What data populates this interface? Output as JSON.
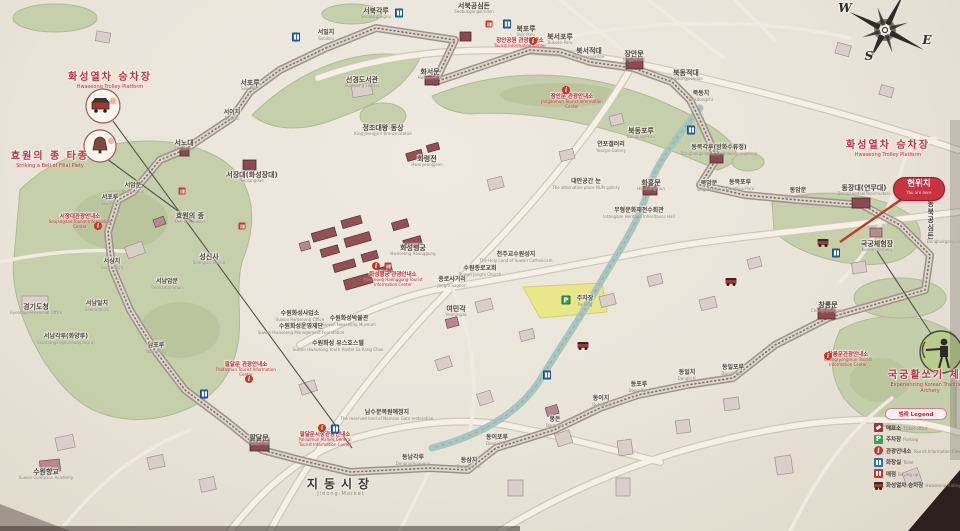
{
  "meta": {
    "description": "Illustrated tourist map of Suwon Hwaseong Fortress (photographed signboard)"
  },
  "compass": {
    "letters": [
      {
        "t": "W",
        "x": 845,
        "y": 2
      },
      {
        "t": "S",
        "x": 869,
        "y": 50
      },
      {
        "t": "E",
        "x": 927,
        "y": 34
      }
    ]
  },
  "you_are_here": {
    "ko": "현위치",
    "en": "You are here"
  },
  "legend": {
    "title_ko": "범례",
    "title_en": "Legend",
    "items": [
      {
        "icon": "ticket-office",
        "ko": "매표소",
        "en": "Ticket office"
      },
      {
        "icon": "parking",
        "ko": "주차장",
        "en": "Parking"
      },
      {
        "icon": "tourist-information",
        "ko": "관광안내소",
        "en": "Tourist Information Center"
      },
      {
        "icon": "toilet",
        "ko": "화장실",
        "en": "Toilet"
      },
      {
        "icon": "snack-shop",
        "ko": "매점",
        "en": "Buying up"
      },
      {
        "icon": "trolley",
        "ko": "화성열차 승차장",
        "en": "Hwaseong Trolley Platform"
      }
    ]
  },
  "colors": {
    "accent_red": "#c5293c",
    "park_green": "#c2cda6",
    "paper": "#e9e4d8",
    "wall_gray": "#9b9289"
  },
  "map": {
    "labels": [
      {
        "x": 110,
        "y": 72,
        "ko": "화성열차 승차장",
        "en": "Hwaseong Trolley Platform",
        "kind": "feature"
      },
      {
        "x": 50,
        "y": 151,
        "ko": "효원의 종 타종",
        "en": "Striking a Bell of Filial Piety",
        "kind": "feature"
      },
      {
        "x": 888,
        "y": 140,
        "ko": "화성열차 승차장",
        "en": "Hwaseong Trolley Platform",
        "kind": "feature"
      },
      {
        "x": 930,
        "y": 370,
        "ko": "국궁활쏘기 체험",
        "en": "Experiencing Korean Traditional Archery",
        "kind": "feature"
      },
      {
        "x": 520,
        "y": 38,
        "ko": "장안공원 관광안내소",
        "en": "Tourist Information Center",
        "kind": "info"
      },
      {
        "x": 572,
        "y": 94,
        "ko": "장안문 관광안내소",
        "en": "Janganmun Tourist Information Center",
        "kind": "info"
      },
      {
        "x": 393,
        "y": 272,
        "ko": "화성행궁 관광안내소",
        "en": "Hwaseong Haenggung Tourist Information Center",
        "kind": "info"
      },
      {
        "x": 80,
        "y": 214,
        "ko": "서장대관광안내소",
        "en": "Seojangdae Tourist Information Center",
        "kind": "info"
      },
      {
        "x": 246,
        "y": 362,
        "ko": "팔달문 관광안내소",
        "en": "Paldalmun Tourist Information Center",
        "kind": "info"
      },
      {
        "x": 325,
        "y": 432,
        "ko": "팔달문시장관광안내소",
        "en": "Paldalmun Market General Tourist Information Center",
        "kind": "info"
      },
      {
        "x": 848,
        "y": 352,
        "ko": "창룡문관광안내소",
        "en": "Changryongmun Tourist Information Center",
        "kind": "info"
      },
      {
        "x": 376,
        "y": 7,
        "ko": "서북각루",
        "en": "Seobukgangnu",
        "kind": "place"
      },
      {
        "x": 474,
        "y": 2,
        "ko": "서북공심돈",
        "en": "Seobukgongsimdon",
        "kind": "place"
      },
      {
        "x": 326,
        "y": 30,
        "ko": "서일치",
        "en": "Seoilchi",
        "kind": "small"
      },
      {
        "x": 526,
        "y": 25,
        "ko": "북포루",
        "en": "Buk-Poru",
        "kind": "place"
      },
      {
        "x": 560,
        "y": 33,
        "ko": "북서포루",
        "en": "Bukseo-Poru",
        "kind": "place"
      },
      {
        "x": 589,
        "y": 47,
        "ko": "북서적대",
        "en": "Bukseojeokdae",
        "kind": "place"
      },
      {
        "x": 634,
        "y": 50,
        "ko": "장안문",
        "en": "Janganmun",
        "kind": "place"
      },
      {
        "x": 686,
        "y": 69,
        "ko": "북동적대",
        "en": "Bukdongjeokdae",
        "kind": "place"
      },
      {
        "x": 701,
        "y": 91,
        "ko": "북동치",
        "en": "Bukdongchi",
        "kind": "small"
      },
      {
        "x": 430,
        "y": 68,
        "ko": "화서문",
        "en": "Hwaseomun",
        "kind": "place"
      },
      {
        "x": 362,
        "y": 76,
        "ko": "선경도서관",
        "en": "Sunkyung Library",
        "kind": "place"
      },
      {
        "x": 250,
        "y": 79,
        "ko": "서포루",
        "en": "Seo-Poru",
        "kind": "place"
      },
      {
        "x": 232,
        "y": 110,
        "ko": "서이치",
        "en": "Seoichi",
        "kind": "small"
      },
      {
        "x": 184,
        "y": 139,
        "ko": "서노대",
        "en": "Seonodae",
        "kind": "place"
      },
      {
        "x": 252,
        "y": 171,
        "ko": "서장대(화성장대)",
        "en": "Seojangdae",
        "kind": "place"
      },
      {
        "x": 133,
        "y": 183,
        "ko": "서암문",
        "en": "Seoammun",
        "kind": "small"
      },
      {
        "x": 110,
        "y": 195,
        "ko": "서포루",
        "en": "Seo-Poru",
        "kind": "small"
      },
      {
        "x": 190,
        "y": 212,
        "ko": "효원의 종",
        "en": "Bell of Hyowon",
        "kind": "place"
      },
      {
        "x": 209,
        "y": 253,
        "ko": "성신사",
        "en": "Seongsin Shrine",
        "kind": "place"
      },
      {
        "x": 112,
        "y": 259,
        "ko": "서삼치",
        "en": "Seosamchi",
        "kind": "small"
      },
      {
        "x": 167,
        "y": 279,
        "ko": "서남암문",
        "en": "Seonamammun",
        "kind": "small"
      },
      {
        "x": 97,
        "y": 301,
        "ko": "서남일치",
        "en": "Seonamilchi",
        "kind": "small"
      },
      {
        "x": 36,
        "y": 303,
        "ko": "경기도청",
        "en": "Gyeonggi Provincial Office",
        "kind": "place"
      },
      {
        "x": 66,
        "y": 334,
        "ko": "서남각루(화양루)",
        "en": "Seonamgangnu(Hwayangru)",
        "kind": "small"
      },
      {
        "x": 156,
        "y": 343,
        "ko": "남포루",
        "en": "Nam-Poru",
        "kind": "small"
      },
      {
        "x": 46,
        "y": 468,
        "ko": "수원향교",
        "en": "Suwon Confucian Academy",
        "kind": "place"
      },
      {
        "x": 383,
        "y": 124,
        "ko": "정조대왕 동상",
        "en": "King Jeongjo's Bronze Statue",
        "kind": "place"
      },
      {
        "x": 427,
        "y": 155,
        "ko": "화령전",
        "en": "Hwaryeongjeon",
        "kind": "place"
      },
      {
        "x": 413,
        "y": 244,
        "ko": "화성행궁",
        "en": "Hwaseong Haenggung",
        "kind": "place"
      },
      {
        "x": 452,
        "y": 277,
        "ko": "종로사거리",
        "en": "Jongro Sageori",
        "kind": "small"
      },
      {
        "x": 456,
        "y": 305,
        "ko": "여민각",
        "en": "Yeomingak",
        "kind": "place"
      },
      {
        "x": 516,
        "y": 252,
        "ko": "천주교수원성지",
        "en": "The Holy Land of Suwon Catholicism",
        "kind": "small"
      },
      {
        "x": 480,
        "y": 266,
        "ko": "수원종로교회",
        "en": "Suwon Jongro Church",
        "kind": "small"
      },
      {
        "x": 641,
        "y": 127,
        "ko": "북동포루",
        "en": "Bukdong-Poru",
        "kind": "place"
      },
      {
        "x": 611,
        "y": 142,
        "ko": "연포갤러리",
        "en": "Yeonpo Gallery",
        "kind": "small"
      },
      {
        "x": 719,
        "y": 145,
        "ko": "동북각루(방화수류정)",
        "en": "Dongbukgangnu(Banghwasuryujeong)",
        "kind": "small"
      },
      {
        "x": 651,
        "y": 179,
        "ko": "화홍문",
        "en": "Hwahongmun",
        "kind": "place"
      },
      {
        "x": 709,
        "y": 181,
        "ko": "북암문",
        "en": "Bugammun",
        "kind": "small"
      },
      {
        "x": 740,
        "y": 180,
        "ko": "동북포루",
        "en": "Dongbuk-Poru",
        "kind": "small"
      },
      {
        "x": 798,
        "y": 188,
        "ko": "동암문",
        "en": "Dongammun",
        "kind": "small"
      },
      {
        "x": 864,
        "y": 184,
        "ko": "동장대(연무대)",
        "en": "Dongjangdae(Yeonmudae)",
        "kind": "place"
      },
      {
        "x": 948,
        "y": 200,
        "ko": "동북공심돈",
        "en": "Dongbukgongsimdon",
        "kind": "place-v"
      },
      {
        "x": 877,
        "y": 240,
        "ko": "국궁체험장",
        "en": "Korean Archery",
        "kind": "place"
      },
      {
        "x": 639,
        "y": 208,
        "ko": "무형문화재전수회관",
        "en": "Intangible Heritage Inheritance Hall",
        "kind": "small"
      },
      {
        "x": 586,
        "y": 179,
        "ko": "대안공간 눈",
        "en": "The alternative place NUN gallery",
        "kind": "small"
      },
      {
        "x": 585,
        "y": 296,
        "ko": "주차장",
        "en": "Parking",
        "kind": "small"
      },
      {
        "x": 828,
        "y": 301,
        "ko": "창룡문",
        "en": "Changnyongmun",
        "kind": "place"
      },
      {
        "x": 733,
        "y": 365,
        "ko": "동일포루",
        "en": "Dongil-Poru",
        "kind": "small"
      },
      {
        "x": 687,
        "y": 370,
        "ko": "동일치",
        "en": "Dongilchi",
        "kind": "small"
      },
      {
        "x": 639,
        "y": 382,
        "ko": "동포루",
        "en": "Dong-Poru",
        "kind": "small"
      },
      {
        "x": 601,
        "y": 396,
        "ko": "동이치",
        "en": "Dongichi",
        "kind": "small"
      },
      {
        "x": 555,
        "y": 417,
        "ko": "봉돈",
        "en": "Bongdon",
        "kind": "small"
      },
      {
        "x": 497,
        "y": 435,
        "ko": "동이포루",
        "en": "Dongi-Poru",
        "kind": "small"
      },
      {
        "x": 469,
        "y": 458,
        "ko": "동삼치",
        "en": "Dongsamchi",
        "kind": "small"
      },
      {
        "x": 413,
        "y": 455,
        "ko": "동남각루",
        "en": "Dongnamgangnu",
        "kind": "small"
      },
      {
        "x": 387,
        "y": 410,
        "ko": "남수문복원예정지",
        "en": "The reserved land of Namsoo Gate restoration",
        "kind": "small"
      },
      {
        "x": 259,
        "y": 434,
        "ko": "팔달문",
        "en": "Paldalmun",
        "kind": "place"
      },
      {
        "x": 300,
        "y": 311,
        "ko": "수원화성사업소",
        "en": "Suwon Hwaseong Office",
        "kind": "small"
      },
      {
        "x": 301,
        "y": 324,
        "ko": "수원화성운영재단",
        "en": "Suwon Hwaseong Management Foundation",
        "kind": "small"
      },
      {
        "x": 349,
        "y": 316,
        "ko": "수원화성박물관",
        "en": "Suwon Hwaseong Museum",
        "kind": "small"
      },
      {
        "x": 338,
        "y": 341,
        "ko": "수원화성 유스호스텔",
        "en": "Suwon Hwaseong Youth Hostel Sa Rang Chae",
        "kind": "small"
      },
      {
        "x": 341,
        "y": 478,
        "ko": "지동시장",
        "en": "Jidong-Market",
        "kind": "market"
      }
    ],
    "icons": [
      {
        "type": "i-toilet",
        "x": 399,
        "y": 13
      },
      {
        "type": "i-toilet",
        "x": 507,
        "y": 24
      },
      {
        "type": "i-toilet",
        "x": 296,
        "y": 37
      },
      {
        "type": "i-toilet",
        "x": 691,
        "y": 130
      },
      {
        "type": "i-toilet",
        "x": 836,
        "y": 253
      },
      {
        "type": "i-toilet",
        "x": 547,
        "y": 375
      },
      {
        "type": "i-toilet",
        "x": 335,
        "y": 429
      },
      {
        "type": "i-toilet",
        "x": 204,
        "y": 394
      },
      {
        "type": "i-parking",
        "x": 566,
        "y": 300
      },
      {
        "type": "i-info",
        "x": 533,
        "y": 41
      },
      {
        "type": "i-info",
        "x": 566,
        "y": 90
      },
      {
        "type": "i-info",
        "x": 376,
        "y": 266
      },
      {
        "type": "i-info",
        "x": 98,
        "y": 226
      },
      {
        "type": "i-info",
        "x": 249,
        "y": 379
      },
      {
        "type": "i-info",
        "x": 322,
        "y": 428
      },
      {
        "type": "i-info",
        "x": 828,
        "y": 356
      },
      {
        "type": "i-shop",
        "x": 489,
        "y": 24
      },
      {
        "type": "i-shop",
        "x": 182,
        "y": 191
      },
      {
        "type": "i-shop",
        "x": 242,
        "y": 226
      },
      {
        "type": "i-shop",
        "x": 388,
        "y": 266
      },
      {
        "type": "i-trolley",
        "x": 823,
        "y": 242
      },
      {
        "type": "i-trolley",
        "x": 731,
        "y": 281
      },
      {
        "type": "i-trolley",
        "x": 583,
        "y": 345
      }
    ]
  }
}
